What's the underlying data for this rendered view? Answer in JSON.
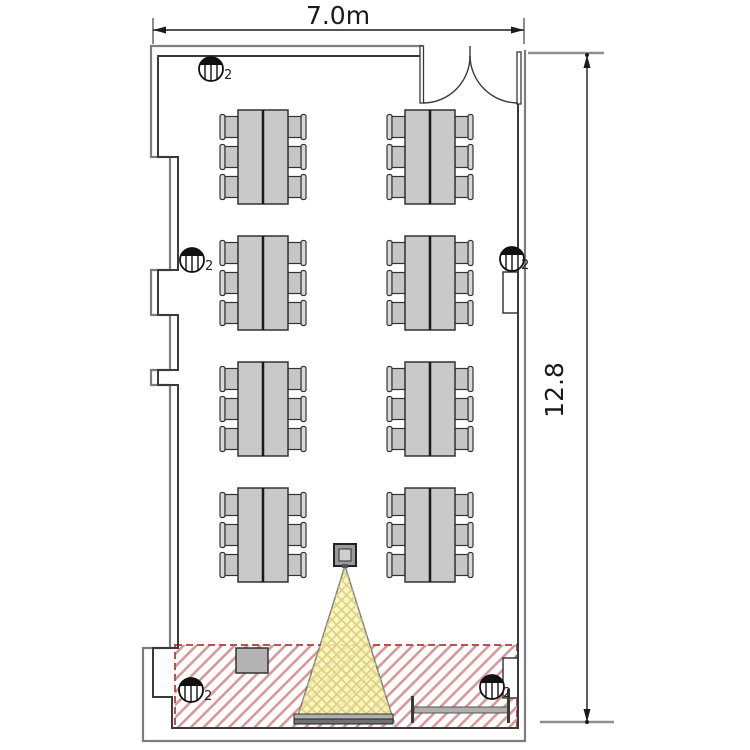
{
  "page": {
    "title": "Room floor plan",
    "type": "architectural-floor-plan"
  },
  "dimensions": {
    "width_label": "7.0m",
    "height_label": "12.8"
  },
  "fixtures": {
    "label": "2",
    "type": "ceiling-light",
    "count": 5
  },
  "furniture": {
    "table_groups": 8,
    "table_rows": 4,
    "table_columns": 2,
    "chairs_per_table": 6,
    "podium_count": 1,
    "side_counter_count": 1
  },
  "equipment": {
    "projector_count": 1,
    "projection_screen_count": 1
  },
  "zones": {
    "presentation_zone": {
      "style": "diagonal-red-hatch",
      "border": "dashed"
    },
    "projector_beam": {
      "style": "yellow-crosshatch"
    }
  },
  "colors": {
    "wall": "#3a3a3a",
    "table_fill": "#c9c9c9",
    "chair_fill": "#c6c6c6",
    "beam_fill": "#faf5b8",
    "beam_hatch": "#d8cc74",
    "zone_hatch": "#c87070",
    "zone_border": "#c0504d",
    "screen_fill": "#707070",
    "dimension_text": "#1a1a1a"
  }
}
